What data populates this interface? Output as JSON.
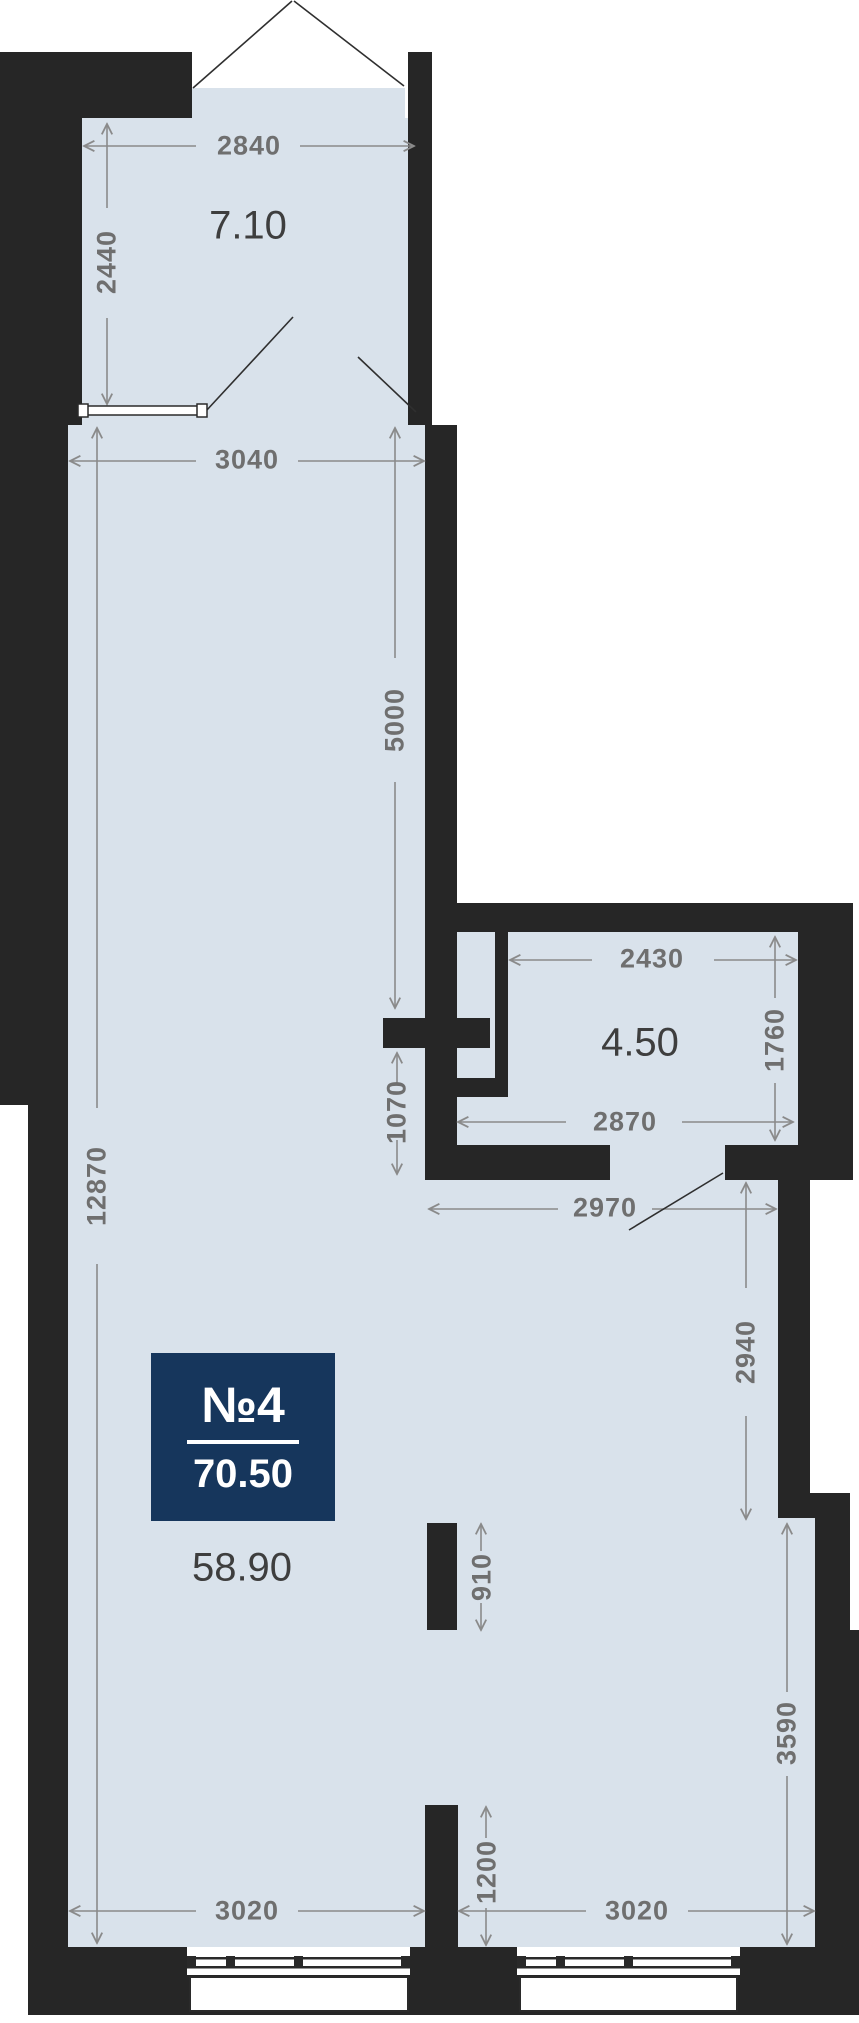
{
  "plan": {
    "badge": {
      "unit_label": "№4",
      "total_area": "70.50"
    },
    "areas": {
      "balcony": "7.10",
      "bathroom": "4.50",
      "living": "58.90"
    },
    "dims": {
      "balcony_width": "2840",
      "balcony_depth": "2440",
      "room_width": "3040",
      "wall_upper": "5000",
      "room_height": "12870",
      "bath_top": "2430",
      "bath_right": "1760",
      "bath_bottom": "2870",
      "passage": "1070",
      "hall_width": "2970",
      "hall_right": "2940",
      "stub_upper": "910",
      "lower_right": "3590",
      "stub_lower": "1200",
      "bottom_left": "3020",
      "bottom_right": "3020"
    },
    "colors": {
      "wall": "#262626",
      "floor": "#d9e2eb",
      "badge_bg": "#16365c",
      "dim_text": "#6f6f6f"
    }
  }
}
